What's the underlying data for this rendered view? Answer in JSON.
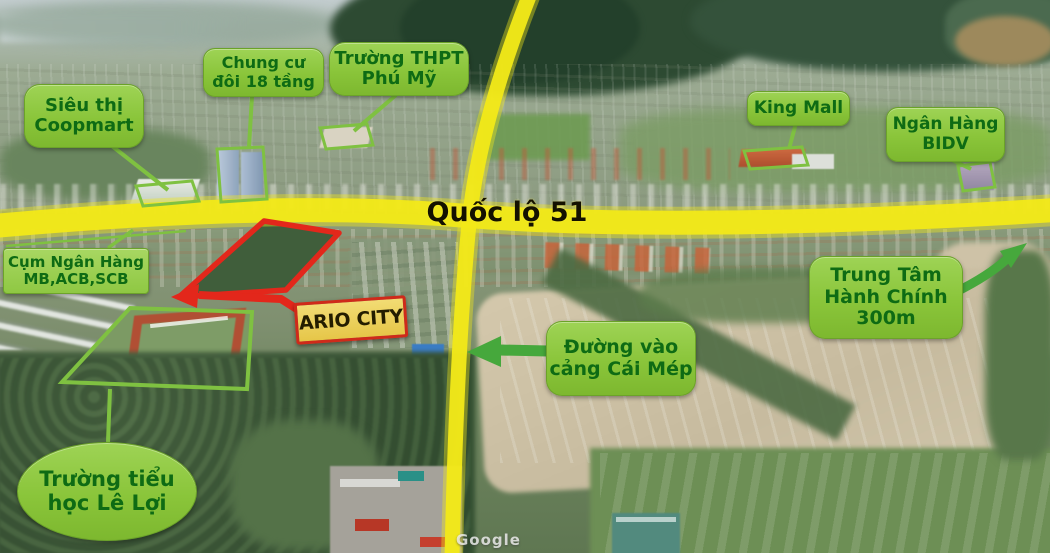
{
  "scene": {
    "highway_label": "Quốc lộ 51",
    "watermark": "Google",
    "project_site_color": "#e3271b",
    "road_color": "#f2e918",
    "label_bg_color": "#8ac53a",
    "label_text_color": "#0e6b14",
    "arrow_color": "#46a83c",
    "project_label_bg": "#eed05e",
    "project_label_border": "#cf2a1a"
  },
  "labels": {
    "coopmart": "Siêu thị\nCoopmart",
    "chung_cu": "Chung cư\nđôi 18 tầng",
    "truong_thpt": "Trường THPT\nPhú Mỹ",
    "king_mall": "King Mall",
    "bidv": "Ngân Hàng\nBIDV",
    "cum_ngan_hang": "Cụm Ngân Hàng\nMB,ACB,SCB",
    "trung_tam": "Trung Tâm\nHành Chính\n300m",
    "duong_vao": "Đường vào\ncảng Cái Mép",
    "truong_tieu_hoc": "Trường tiểu\nhọc Lê Lợi",
    "project": "ARIO CITY"
  }
}
